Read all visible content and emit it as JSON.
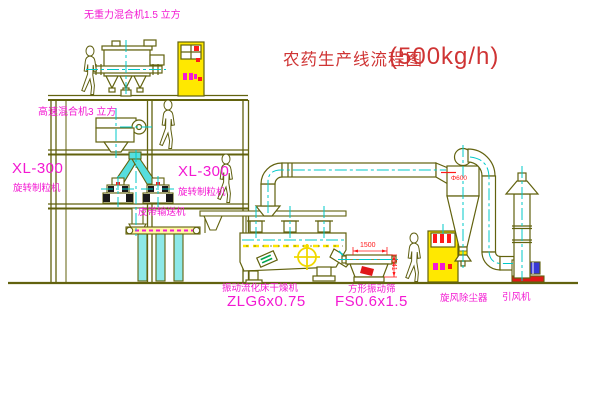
{
  "title": {
    "main": "农药生产线流程图",
    "capacity": "(500kg/h)"
  },
  "equipment_labels": {
    "gravity_mixer": "无重力混合机1.5 立方",
    "high_speed_mixer": "高速混合机3 立方",
    "granulator_left_model": "XL-300",
    "granulator_left_name": "旋转制粒机",
    "granulator_right_model": "XL-300",
    "granulator_right_name": "旋转制粒机",
    "belt_conveyor": "皮带输送机",
    "fluid_bed_dryer_name": "振动流化床干燥机",
    "fluid_bed_dryer_model": "ZLG6x0.75",
    "square_sieve_name": "方形振动筛",
    "square_sieve_model": "FS0.6x1.5",
    "cyclone_dust_collector": "旋风除尘器",
    "induced_draft_fan": "引风机"
  },
  "dimensions": {
    "sieve_length": "1500",
    "sieve_height": "541",
    "cyclone_note": "Φ600"
  },
  "colors": {
    "cad_line": "#62620e",
    "centerline_cyan": "#00c8c8",
    "label_magenta": "#f318d2",
    "title_red": "#cf3434",
    "dimension_red": "#ff1a1a",
    "fill_yellow": "#ffe800",
    "fill_cyan": "#56dede",
    "motor_blue": "#3939d8",
    "nameplate_green": "#00a550"
  }
}
